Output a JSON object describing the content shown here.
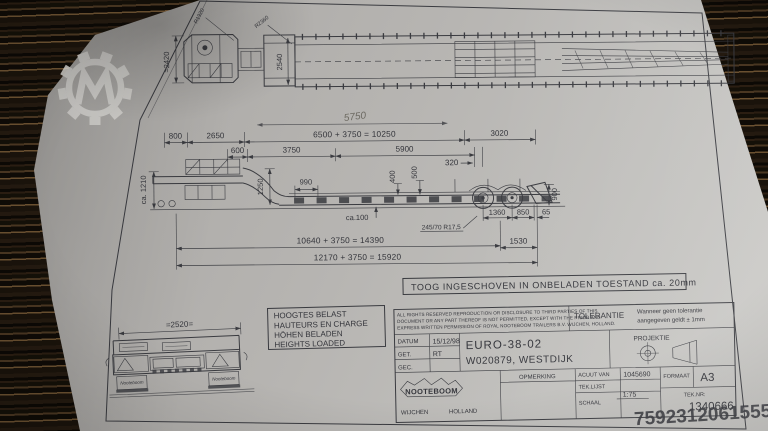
{
  "photo": {
    "watermark_id": "7592312061555"
  },
  "sheet": {
    "note": "TOOG INGESCHOVEN IN ONBELADEN TOESTAND ca. 20mm",
    "heights": {
      "nl": "HOOGTES BELAST",
      "fr": "HAUTEURS EN CHARGE",
      "de": "HÖHEN BELADEN",
      "en": "HEIGHTS LOADED"
    },
    "dims": {
      "w2420": "≈2420",
      "w2540": "2540",
      "r_left": "R1320",
      "r_right": "R2360",
      "hand5750": "5750",
      "d800": "800",
      "d2650": "2650",
      "eq_top": "6500 + 3750 = 10250",
      "d3020": "3020",
      "d600": "600",
      "d3750": "3750",
      "d5900": "5900",
      "d320": "320",
      "v1250": "1250",
      "d990": "990",
      "v400": "400",
      "v500": "500",
      "v900": "900",
      "h1210": "ca. 1210",
      "clearance": "ca.100",
      "d1360": "1360",
      "d850": "850",
      "d65": "65",
      "tyre": "245/70 R17,5",
      "d1530": "1530",
      "eq_mid": "10640 + 3750 = 14390",
      "eq_total": "12170 + 3750 = 15920",
      "w2520": "=2520="
    },
    "rear": {
      "mudflap": "Nooteboom"
    },
    "title_block": {
      "legal1": "ALL RIGHTS RESERVED REPRODUCTION OR DISCLOSURE TO THIRD PARTIES OF THIS",
      "legal2": "DOCUMENT OR ANY PART THEREOF IS NOT PERMITTED, EXCEPT WITH THE PRIOR AND",
      "legal3": "EXPRESS WRITTEN PERMISSION OF ROYAL NOOTEBOOM TRAILERS B.V. WIJCHEN, HOLLAND.",
      "tolerantie_label": "TOLERANTIE",
      "tolerantie_line1": "Wanneer geen tolerantie",
      "tolerantie_line2": "aangegeven geldt ± 1mm",
      "projektie_label": "PROJEKTIE",
      "datum_label": "DATUM",
      "datum_value": "15/12/98",
      "get_label": "GET.",
      "get_value": "RT",
      "gec_label": "GEC.",
      "type_line1": "EURO-38-02",
      "type_line2": "W020879, WESTDIJK",
      "opmerking_label": "OPMERKING",
      "acuut_label": "ACUUT VAN",
      "acuut_value": "1045690",
      "teklijst_label": "TEK.LIJST",
      "schaal_label": "SCHAAL",
      "schaal_value": "1:75",
      "formaat_label": "FORMAAT",
      "formaat_value": "A3",
      "teknr_label": "TEK.NR:",
      "teknr_value": "1340666",
      "brand": "NOOTEBOOM",
      "city": "WIJCHEN",
      "country": "HOLLAND"
    }
  }
}
